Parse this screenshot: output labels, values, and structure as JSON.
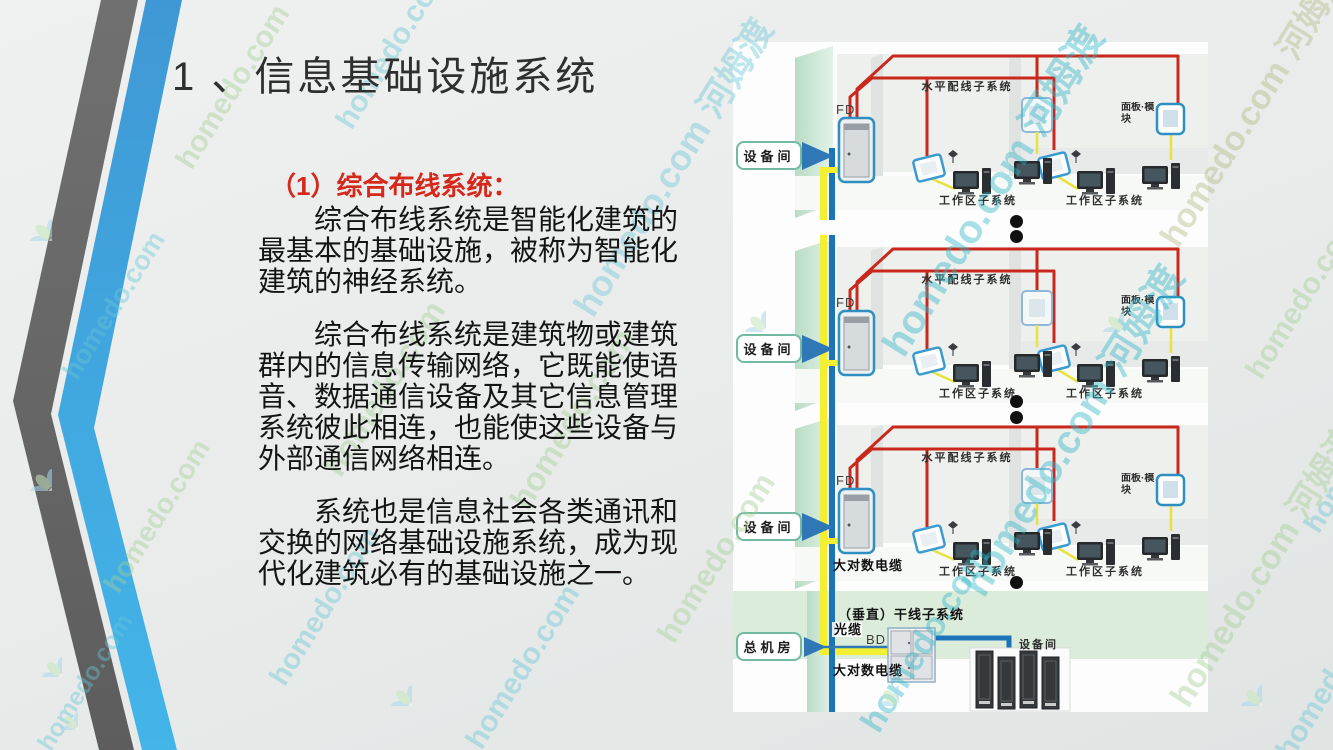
{
  "slide": {
    "title": "1 、信息基础设施系统",
    "heading": "（1）综合布线系统：",
    "paragraphs": [
      "综合布线系统是智能化建筑的最基本的基础设施，被称为智能化建筑的神经系统。",
      "综合布线系统是建筑物或建筑群内的信息传输网络，它既能使语音、数据通信设备及其它信息管理系统彼此相连，也能使这些设备与外部通信网络相连。",
      "系统也是信息社会各类通讯和交换的网络基础设施系统，成为现代化建筑必有的基础设施之一。"
    ]
  },
  "diagram": {
    "floors": [
      {
        "equip_room": "设备间",
        "fd_label": "FD",
        "h_label": "水平配线子系统",
        "workarea1": "工作区子系统",
        "workarea2": "工作区子系统",
        "panel": "面板·模块"
      },
      {
        "equip_room": "设备间",
        "fd_label": "FD",
        "h_label": "水平配线子系统",
        "workarea1": "工作区子系统",
        "workarea2": "工作区子系统",
        "panel": "面板·模块"
      },
      {
        "equip_room": "设备间",
        "fd_label": "FD",
        "h_label": "水平配线子系统",
        "workarea1": "工作区子系统",
        "workarea2": "工作区子系统",
        "panel": "面板·模块",
        "cable_label": "大对数电缆"
      }
    ],
    "basement": {
      "main_room": "总机房",
      "riser_label": "（垂直）干线子系统",
      "fiber_label": "光缆",
      "bd_label": "BD",
      "copper_label": "大对数电缆",
      "equip_room": "设备间"
    },
    "colors": {
      "cable_red": "#c9291c",
      "trunk_blue": "#1c74b8",
      "trunk_yellow": "#f3ef33",
      "box_border": "#74b9a2",
      "cabinet_blue": "#2e8fc0"
    }
  },
  "watermarks": {
    "domain": "homedo.com",
    "combo": "homedo.com 河姆渡",
    "brand": "河姆渡"
  },
  "decoration": {
    "stripe_gray": "#6a6a6a",
    "stripe_blue_top": "#3f98d5",
    "stripe_blue_bottom": "#43b5e9"
  }
}
